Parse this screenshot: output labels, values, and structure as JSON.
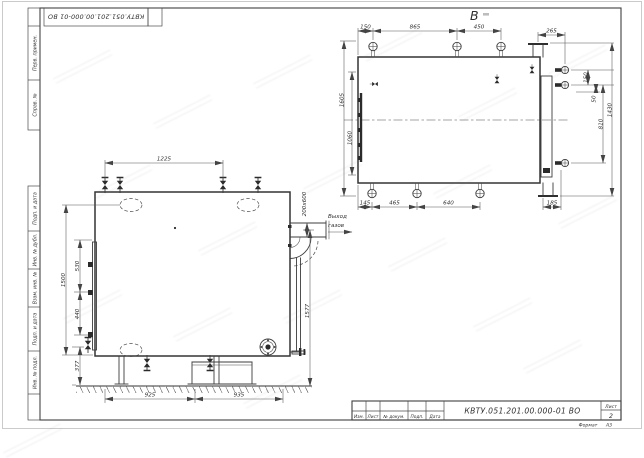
{
  "stamp": {
    "doc_number": "КВТУ.051.201.00.000-01 ВО"
  },
  "margin": {
    "labels_top": [
      "Перв. примен.",
      "Справ. №"
    ],
    "labels_bottom": [
      "Подп. и дата",
      "Инв. № дубл.",
      "Взам. инв. №",
      "Подп. и дата",
      "Инв. № подл."
    ]
  },
  "title_block": {
    "doc_number": "КВТУ.051.201.00.000-01 ВО",
    "columns": [
      "Изм.",
      "Лист",
      "№ докум.",
      "Подп.",
      "Дата"
    ],
    "sheet_label": "Лист",
    "sheet_number": "2",
    "format_label": "Формат",
    "format_value": "А3"
  },
  "top_view": {
    "label": "В",
    "dims_top": [
      "150",
      "865",
      "450"
    ],
    "dim_265": "265",
    "dims_right": [
      "150",
      "50",
      "810",
      "1430"
    ],
    "dims_left": [
      "1605",
      "1060"
    ],
    "dims_bottom": [
      "145",
      "465",
      "640",
      "185"
    ]
  },
  "front_view": {
    "dim_top": "1225",
    "dim_height_total": "1500",
    "dims_left": [
      "530",
      "440"
    ],
    "dim_ground": "377",
    "dims_bottom": [
      "925",
      "935"
    ],
    "dim_right": "1577",
    "duct_section": "200х600",
    "outlet_line1": "Выход",
    "outlet_line2": "газов"
  }
}
